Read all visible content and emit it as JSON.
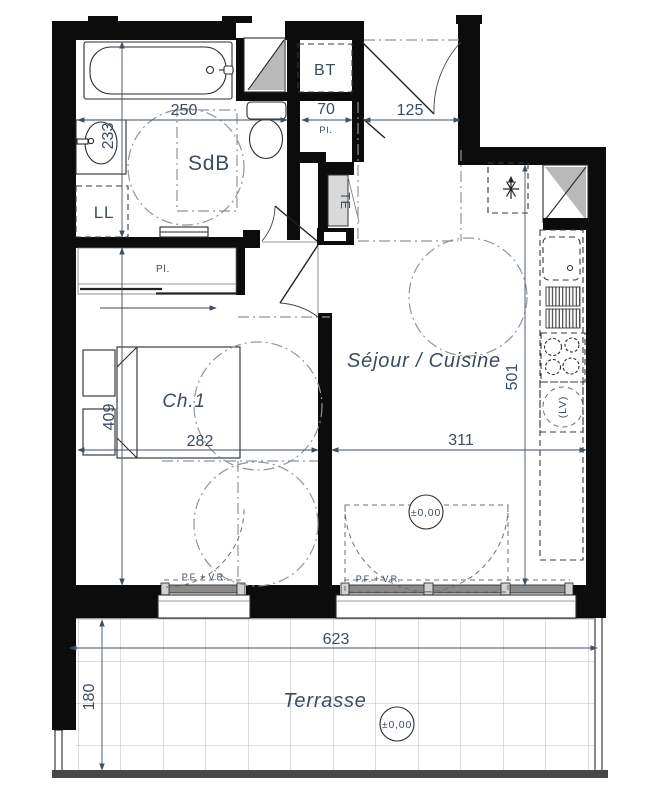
{
  "rooms": {
    "sdb": "SdB",
    "ll": "LL",
    "bt": "BT",
    "te": "TE",
    "pl_hall": "Pl.",
    "pl_small": "Pl.",
    "ch1": "Ch.1",
    "sejour": "Séjour / Cuisine",
    "terrasse": "Terrasse",
    "lv": "(LV)"
  },
  "dimensions": {
    "sdb_width": "250",
    "sdb_depth": "233",
    "closet_width": "70",
    "entry_width": "125",
    "ch1_width": "282",
    "ch1_depth": "409",
    "sejour_width": "311",
    "sejour_depth": "501",
    "terrace_width": "623",
    "terrace_depth": "180"
  },
  "windows": {
    "ch1_label": "P.F. + V.R.",
    "sejour_label": "P.F. + V.R."
  },
  "levels": {
    "sejour": "±0,00",
    "terrace": "±0,00"
  },
  "colors": {
    "wall": "#0c0c0c",
    "window_glass": "#b9b9b9",
    "te_panel": "#d9d9d9",
    "dim_text": "#3b4c61",
    "tile_grid": "#a8a8a8",
    "terrace_edge": "#474747"
  }
}
